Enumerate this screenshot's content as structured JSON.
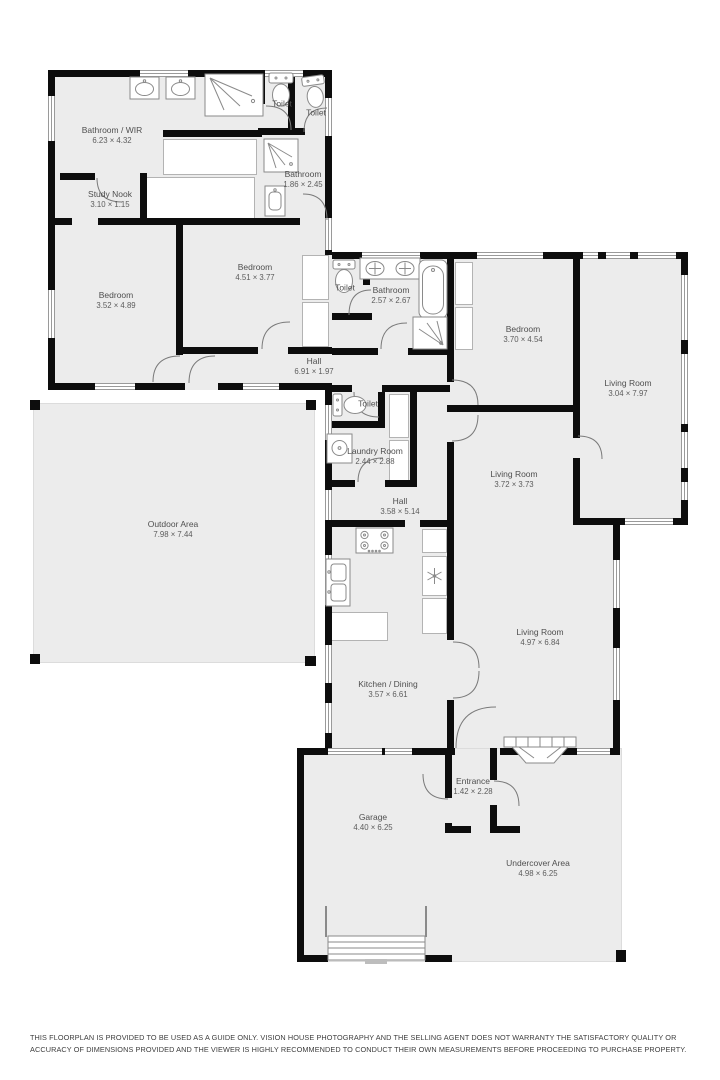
{
  "rooms": [
    {
      "name": "Bathroom / WIR",
      "dims": "6.23 × 4.32"
    },
    {
      "name": "Study Nook",
      "dims": "3.10 × 1.15"
    },
    {
      "name": "Bedroom",
      "dims": "4.51 × 3.77"
    },
    {
      "name": "Bedroom",
      "dims": "3.52 × 4.89"
    },
    {
      "name": "Bathroom",
      "dims": "1.86 × 2.45"
    },
    {
      "name": "Toilet",
      "dims": ""
    },
    {
      "name": "Toilet",
      "dims": ""
    },
    {
      "name": "Hall",
      "dims": "6.91 × 1.97"
    },
    {
      "name": "Toilet",
      "dims": ""
    },
    {
      "name": "Bathroom",
      "dims": "2.57 × 2.67"
    },
    {
      "name": "Bedroom",
      "dims": "3.70 × 4.54"
    },
    {
      "name": "Living Room",
      "dims": "3.04 × 7.97"
    },
    {
      "name": "Toilet",
      "dims": ""
    },
    {
      "name": "Laundry Room",
      "dims": "2.44 × 2.88"
    },
    {
      "name": "Hall",
      "dims": "3.58 × 5.14"
    },
    {
      "name": "Living Room",
      "dims": "3.72 × 3.73"
    },
    {
      "name": "Living Room",
      "dims": "4.97 × 6.84"
    },
    {
      "name": "Kitchen / Dining",
      "dims": "3.57 × 6.61"
    },
    {
      "name": "Outdoor Area",
      "dims": "7.98 × 7.44"
    },
    {
      "name": "Entrance",
      "dims": "1.42 × 2.28"
    },
    {
      "name": "Garage",
      "dims": "4.40 × 6.25"
    },
    {
      "name": "Undercover Area",
      "dims": "4.98 × 6.25"
    }
  ],
  "disclaimer": "THIS FLOORPLAN IS PROVIDED TO BE USED AS A GUIDE ONLY. VISION HOUSE PHOTOGRAPHY AND THE SELLING AGENT DOES NOT WARRANTY THE SATISFACTORY QUALITY OR ACCURACY OF DIMENSIONS PROVIDED AND THE VIEWER IS HIGHLY RECOMMENDED TO CONDUCT THEIR OWN MEASUREMENTS BEFORE PROCEEDING TO PURCHASE PROPERTY.",
  "colors": {
    "wall": "#0d0d0d",
    "floor": "#ececec",
    "label_text": "#4f4f4f",
    "fixture_stroke": "#8a8a8a"
  }
}
